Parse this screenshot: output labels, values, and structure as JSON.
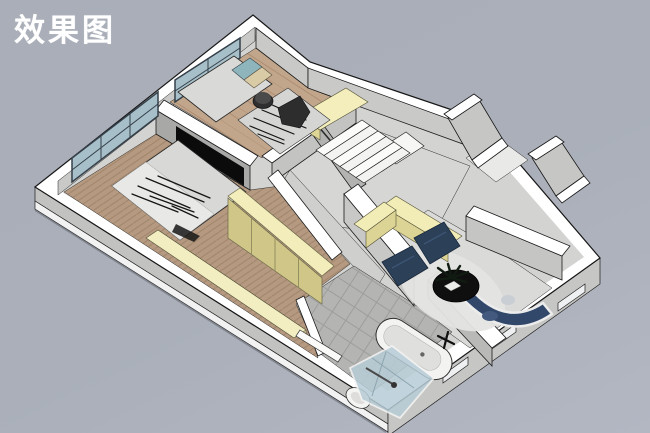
{
  "title": "效果图",
  "palette": {
    "background": "#a9aeb8",
    "wall_top": "#ffffff",
    "wall_face_light": "#c9c9c7",
    "wall_face_dark": "#a8a8a6",
    "wood_floor": "#b59a81",
    "cabinet_yellow_top": "#f2edbb",
    "cabinet_yellow_front": "#cfc687",
    "window_glass": "#a7bfc8",
    "navy_furniture": "#2c4158",
    "coffee_table_black": "#0f0f0f",
    "tv_black": "#0b0b0b"
  },
  "scene": {
    "type": "3d-floorplan-render",
    "rooms": [
      "master-bedroom",
      "second-bedroom",
      "stair-hall",
      "corridor",
      "entry",
      "living-room",
      "bathroom"
    ],
    "furniture": [
      "double-bed",
      "single-bed",
      "wall-tv",
      "wardrobe-row",
      "window-bench",
      "staircase",
      "stair-cabinet",
      "yellow-counter",
      "lounge-chair",
      "round-coffee-table",
      "plant",
      "curved-sofa",
      "bathtub",
      "shower-enclosure",
      "toilet",
      "towel-rail",
      "windows"
    ]
  }
}
